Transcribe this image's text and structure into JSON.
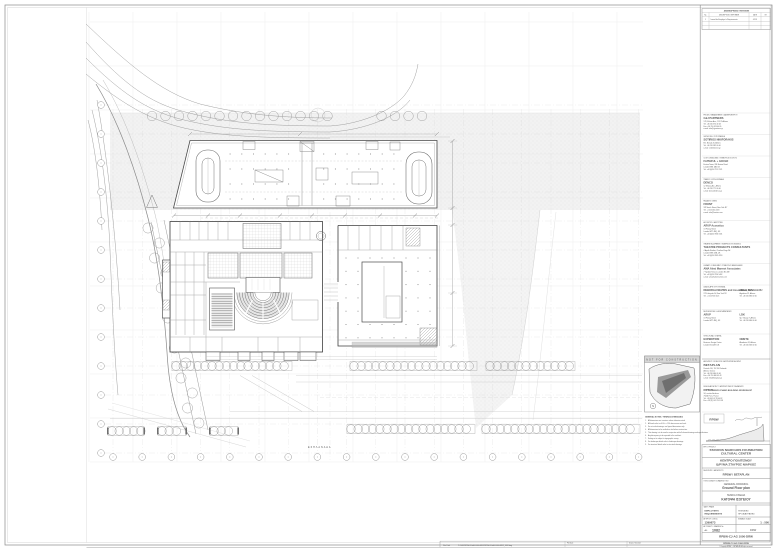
{
  "sheet": {
    "stamp_text": "NOT FOR CONSTRUCTION",
    "esplanade_label": "ΕΣΠΛΑΝΑΔΑ",
    "north_label": "N"
  },
  "revisions": {
    "title": "ΑΝΑΘΕΩΡΗΣΕΙΣ / REVISIONS",
    "columns": [
      "No.",
      "DESCRIPTION / ΠΕΡΙΓΡΑΦΗ",
      "DATE",
      "BY"
    ],
    "rows": [
      [
        "1",
        "Issued for Employer's Requirements",
        "02.13",
        ""
      ]
    ]
  },
  "consultants": [
    {
      "role": "PROJECT MANAGEMENT / ΔΙΑΧΕΙΡΙΣΗ ΕΡΓΟΥ",
      "name": "C&J PARTNERS",
      "lines": [
        "178, Kifisias Ave., 115 25 Athens",
        "Tel: +30 210 674 40 64",
        "Fax: +30 210 674 40 65",
        "e-mail: info@cjpartners.gr"
      ]
    },
    {
      "role": "SURVEYING / ΤΟΠΟΓΡΑΦΙΚΑ",
      "name": "SOTIRIOS NIKIFORAKIS",
      "lines": [
        "Em. Benaki 20, Athens",
        "Tel: +30 210 382 00 00",
        "e-mail: snik@otenet.gr"
      ]
    },
    {
      "role": "COST CONSULTANT / ΣΥΜΒΟΥΛΟΣ ΚΟΣΤΟΥΣ",
      "name": "FAITHFUL + GOULD",
      "lines": [
        "Euston Tower, 286 Euston Road",
        "London NW1 3AT, UK",
        "Tel: +44 (0)20 7121 2121"
      ]
    },
    {
      "role": "TRAFFIC / ΚΥΚΛΟΦΟΡΙΑΚΑ",
      "name": "DENCO",
      "lines": [
        "12 Kifisias Ave., Athens",
        "Tel: +30 210 771 00 00",
        "e-mail: denco@denco.gr"
      ]
    },
    {
      "role": "FACADES / ΟΨΕΙΣ",
      "name": "FRONT",
      "lines": [
        "185 Varick Street, New York NY",
        "Tel: +1 212 242 2220",
        "e-mail: info@frontinc.com"
      ]
    },
    {
      "role": "ACOUSTICS / ΑΚΟΥΣΤΙΚΗ",
      "name": "ARUP Acoustics",
      "lines": [
        "13 Fitzroy Street",
        "London W1T 4BQ, UK",
        "Tel: +44 (0)20 7636 1531"
      ]
    },
    {
      "role": "THEATRE EQUIPMENT / ΘΕΑΤΡΙΚΟΣ ΕΞΟΠΛΙΣΜΟΣ",
      "name": "THEATRE PROJECTS CONSULTANTS",
      "lines": [
        "4 Apollo Studios, Charlton Kings Rd",
        "London NW5 2SB, UK",
        "Tel: +44 (0)20 7482 4224"
      ]
    },
    {
      "role": "LIBRARY CONSULTANT / ΣΥΜΒΟΥΛΟΣ ΒΙΒΛΙΟΘΗΚΗΣ",
      "name": "AMA Alexi Marmot Associates",
      "lines": [
        "7 Tyndale Terrace, London N1 2AT",
        "Tel: +44 (0)20 7354 5402",
        "e-mail: ama@aleximarmot.com"
      ]
    },
    {
      "role": "LANDSCAPE / ΦΥΤΟΤΕΧΝΙΚΑ",
      "name": "DEBORAH NEVINS and Associates, Inc.",
      "lines": [
        "270 Lafayette St, New York NY",
        "Tel: +1 212 925 1125"
      ],
      "right": {
        "name": "NELLI PANGALOU",
        "lines": [
          "Aigialeias 32, Athens",
          "Tel: +30 210 680 00 00"
        ]
      }
    },
    {
      "role": "MEP SERVICES / Η-Μ ΕΓΚΑΤΑΣΤΑΣΕΙΣ",
      "name": "ARUP",
      "lines": [
        "13 Fitzroy Street",
        "London W1T 4BQ, UK"
      ],
      "right": {
        "name": "LDK",
        "lines": [
          "Sp. Trikoupi 7, Athens",
          "Tel: +30 210 680 00 00"
        ]
      }
    },
    {
      "role": "STRUCTURAL / ΣΤΑΤΙΚΑ",
      "name": "EXPEDITION",
      "lines": [
        "Business Design Centre",
        "London N1 0QH, UK"
      ],
      "right": {
        "name": "OMETE",
        "lines": [
          "Akadimias 32, Athens",
          "Tel: +30 210 363 00 00"
        ]
      }
    }
  ],
  "architects": {
    "betaplan": {
      "role": "ARCHITECT OF RECORD / ΑΡΧΙΤΕΚΤΩΝ ΜΕΛΕΤΗΣ",
      "name": "BETAPLAN",
      "lines": [
        "Pentelis 110, 152 34 Chalandri",
        "Athens, Greece",
        "Tel: +30 210 680 09 46",
        "Fax: +30 210 680 09 43",
        "e-mail: info@betaplan.gr"
      ]
    },
    "rpbw": {
      "role": "DESIGN ARCHITECT / ΑΡΧΙΤΕΚΤΟΝΙΚΟΣ ΣΧΕΔΙΑΣΜΟΣ",
      "name": "RPBW",
      "name2": "RENZO PIANO BUILDING WORKSHOP",
      "lines": [
        "34, rue des Archives",
        "75004 Paris, France",
        "Tel: +33 (0)1 42 78 00 82",
        "Fax: +33 (0)1 42 78 01 98"
      ],
      "logo": "RPBW"
    }
  },
  "notes": {
    "title": "GENERAL NOTES / ΓΕΝΙΚΕΣ ΣΗΜΕΙΩΣΕΙΣ",
    "items": [
      "All dimensions are in meters unless otherwise noted.",
      "All levels refer to ±0.00 = +1.50 above mean sea level.",
      "Do not scale drawings; use figured dimensions only.",
      "All dimensions to be verified on site before construction.",
      "This drawing is to be read in conjunction with all relevant drawings and specifications.",
      "Any discrepancy to be reported to the architect.",
      "Setting out is subject to topographic survey.",
      "For landscape details refer to landscape drawings.",
      "For structural details refer to structural drawings."
    ]
  },
  "titleblock": {
    "project_label": "ΕΡΓΟ / PROJECT",
    "project_en_1": "STAVROS NIARCHOS FOUNDATION",
    "project_en_2": "CULTURAL CENTER",
    "project_gr_1": "ΚΕΝΤΡΟ ΠΟΛΙΤΙΣΜΟΥ",
    "project_gr_2": "ΙΔΡΥΜΑ ΣΤΑΥΡΟΣ ΝΙΑΡΧΟΣ",
    "architects_label": "ΜΕΛΕΤΗΤΕΣ / ARCHITECTS",
    "architects_row": "RPBW / BETAPLAN",
    "title_label": "ΤΙΤΛΟΣ ΣΧΕΔΙΟΥ / DRAWING TITLE",
    "category_en": "GENERAL DRAWING",
    "title_en": "Ground Floor plan",
    "category_gr": "ΓΕΝΙΚΑ ΣΧΕΔΙΑ",
    "title_gr": "ΚΑΤΟΨΗ ΙΣΟΓΕΙΟΥ",
    "phase_label": "ΦΑΣΗ / PHASE",
    "phase_en_1": "EMPLOYER'S",
    "phase_en_2": "REQUIREMENTS",
    "phase_gr_1": "ΤΕΧΝΙΚΕΣ",
    "phase_gr_2": "ΠΡΟΔΙΑΓΡΑΦΕΣ",
    "job_label": "ΑΡ. ΕΡΓΟΥ / JOB No",
    "job_no": "1399673",
    "scale_label": "ΚΛΙΜΑΚΑ / SCALE",
    "scale": "1 : 500",
    "number_label": "ΑΡ. ΣΧΕΔΙΟΥ / DRAWING No",
    "sheet_size": "A0",
    "drawing_no": "1082",
    "type_code": "DRW",
    "doc_code": "RPBW-CJ-AG 1000-DRW"
  },
  "footer": {
    "plot_label": "Plot Date",
    "drawn_label": "Drawn / Checked",
    "file_path_label": "File Path",
    "file_path": "P:/1082/RPBW-CJ-AG-1000-DRW/RPBW-CJ-AG-1000-DRW_1082.dwg",
    "doc_code_footer": "RPBW-CJ-AG 1000-DRW",
    "copyright": "© Copyright RPBW — BETAPLAN. All rights reserved."
  }
}
